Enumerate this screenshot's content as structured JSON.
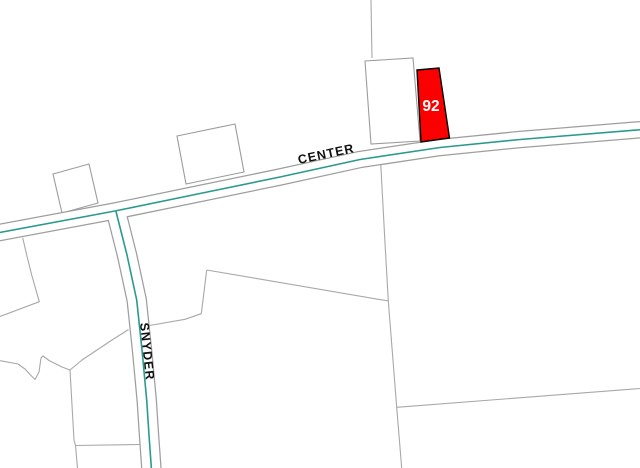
{
  "map": {
    "labels": {
      "center_road": "CENTER",
      "snyder_road": "SNYDER",
      "parcel_number": "92"
    },
    "colors": {
      "background": "#ffffff",
      "parcel_line": "#a8a8a8",
      "building_line": "#9c9c9c",
      "building_fill": "#ffffff",
      "road_casing": "#9e9e9e",
      "road_fill": "#ffffff",
      "road_centerline": "#2a9a8e",
      "highlight_fill": "#fb0000",
      "highlight_stroke": "#000000",
      "road_label_color": "#101010",
      "parcel_label_color": "#ffffff"
    },
    "geometry": {
      "width": 640,
      "height": 468,
      "roads": [
        {
          "id": "center",
          "width": 15,
          "casing_width": 17.5,
          "points": [
            [
              -3,
              233
            ],
            [
              115,
              211
            ],
            [
              200,
              193.5
            ],
            [
              280,
              177
            ],
            [
              360,
              159.5
            ],
            [
              440,
              147.5
            ],
            [
              520,
              139.5
            ],
            [
              643,
              129.5
            ]
          ],
          "label": {
            "bind": "center_road",
            "x": 327,
            "y": 158,
            "rotate": -12,
            "size": 12.5,
            "spacing": 1
          }
        },
        {
          "id": "snyder",
          "width": 18,
          "casing_width": 20.5,
          "points": [
            [
              116,
              211.5
            ],
            [
              127,
              255
            ],
            [
              136.7,
              300
            ],
            [
              142,
              350
            ],
            [
              146.7,
              400
            ],
            [
              149,
              435
            ],
            [
              151.5,
              470
            ]
          ],
          "label": {
            "bind": "snyder_road",
            "x": 143,
            "y": 352,
            "rotate": 84,
            "size": 12.5,
            "spacing": 1
          }
        }
      ],
      "parcel_lines": [
        [
          [
            371,
            0
          ],
          [
            372,
            58
          ]
        ],
        [
          [
            380.7,
            163
          ],
          [
            385,
            243
          ],
          [
            388.3,
            301
          ],
          [
            396.7,
            407.3
          ],
          [
            401.7,
            468
          ]
        ],
        [
          [
            206.7,
            270
          ],
          [
            388.5,
            301
          ]
        ],
        [
          [
            396.7,
            407.3
          ],
          [
            640,
            388.5
          ]
        ],
        [
          [
            206.7,
            270
          ],
          [
            201.3,
            313.7
          ],
          [
            185,
            319.3
          ],
          [
            149.5,
            325.5
          ]
        ],
        [
          [
            22.7,
            237.7
          ],
          [
            26.7,
            255
          ],
          [
            31.7,
            275
          ],
          [
            39.3,
            301.7
          ],
          [
            0,
            316.5
          ]
        ],
        [
          [
            0,
            360.7
          ],
          [
            18,
            364
          ],
          [
            25,
            369
          ],
          [
            31,
            375.5
          ],
          [
            35,
            379.5
          ],
          [
            39,
            372
          ],
          [
            41,
            358
          ],
          [
            43,
            356
          ],
          [
            49,
            360.5
          ],
          [
            62,
            367
          ],
          [
            70,
            370
          ],
          [
            82,
            360
          ],
          [
            103,
            346
          ],
          [
            112,
            340
          ],
          [
            128.5,
            329.5
          ]
        ],
        [
          [
            70,
            370
          ],
          [
            74,
            440
          ],
          [
            75.5,
            445.5
          ],
          [
            77.5,
            468
          ]
        ],
        [
          [
            75.5,
            445.5
          ],
          [
            139.5,
            444.5
          ]
        ]
      ],
      "buildings": [
        [
          [
            53,
            174
          ],
          [
            89,
            164
          ],
          [
            98,
            203
          ],
          [
            62,
            213
          ]
        ],
        [
          [
            177,
            136
          ],
          [
            235,
            124
          ],
          [
            244,
            172
          ],
          [
            186,
            184
          ]
        ],
        [
          [
            365,
            61
          ],
          [
            413,
            58
          ],
          [
            420,
            141
          ],
          [
            371,
            144
          ]
        ]
      ],
      "highlight_parcel": {
        "points": [
          [
            417,
            70
          ],
          [
            439,
            68
          ],
          [
            449.5,
            138
          ],
          [
            421,
            142
          ]
        ],
        "label_x": 431,
        "label_y": 111,
        "label_size": 15.5
      }
    }
  }
}
